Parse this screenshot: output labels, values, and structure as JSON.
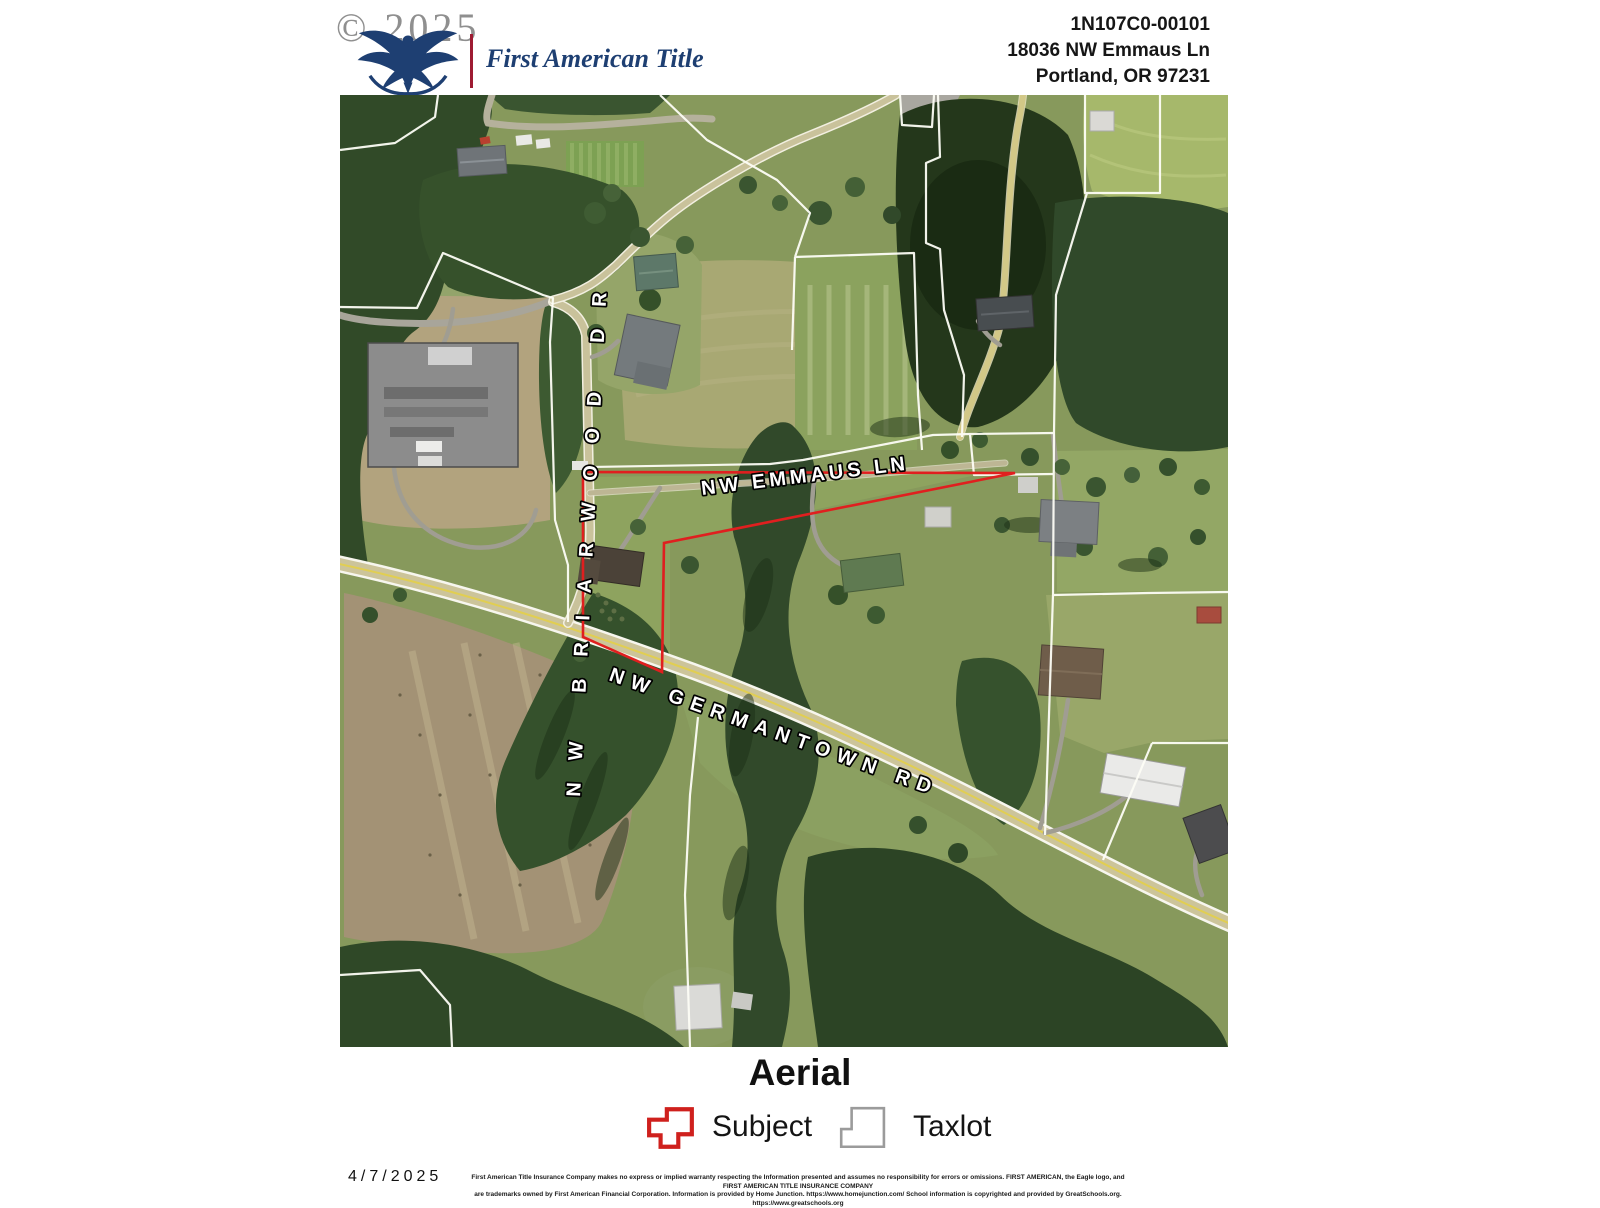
{
  "header": {
    "copyright": "© 2025",
    "brand": "First American Title",
    "parcel_id": "1N107C0-00101",
    "address_line1": "18036 NW Emmaus Ln",
    "address_line2": "Portland, OR 97231"
  },
  "map": {
    "road_labels": {
      "briarwood": "NW BRIARWOOD DR",
      "emmaus": "NW EMMAUS LN",
      "germantown": "NW GERMANTOWN RD"
    },
    "subject_outline_color": "#e01f1f",
    "taxlot_line_color": "#ffffff"
  },
  "footer": {
    "title": "Aerial",
    "legend": {
      "subject_label": "Subject",
      "taxlot_label": "Taxlot"
    },
    "date": "4/7/2025",
    "disclaimer_line1": "First American Title Insurance Company makes no express or implied warranty respecting the Information presented and assumes no responsibility for errors or omissions. FIRST AMERICAN, the Eagle logo, and FIRST AMERICAN TITLE INSURANCE COMPANY",
    "disclaimer_line2": "are trademarks owned by First American Financial Corporation. Information is provided by Home Junction. https://www.homejunction.com/ School information is copyrighted and provided by GreatSchools.org. https://www.greatschools.org"
  }
}
